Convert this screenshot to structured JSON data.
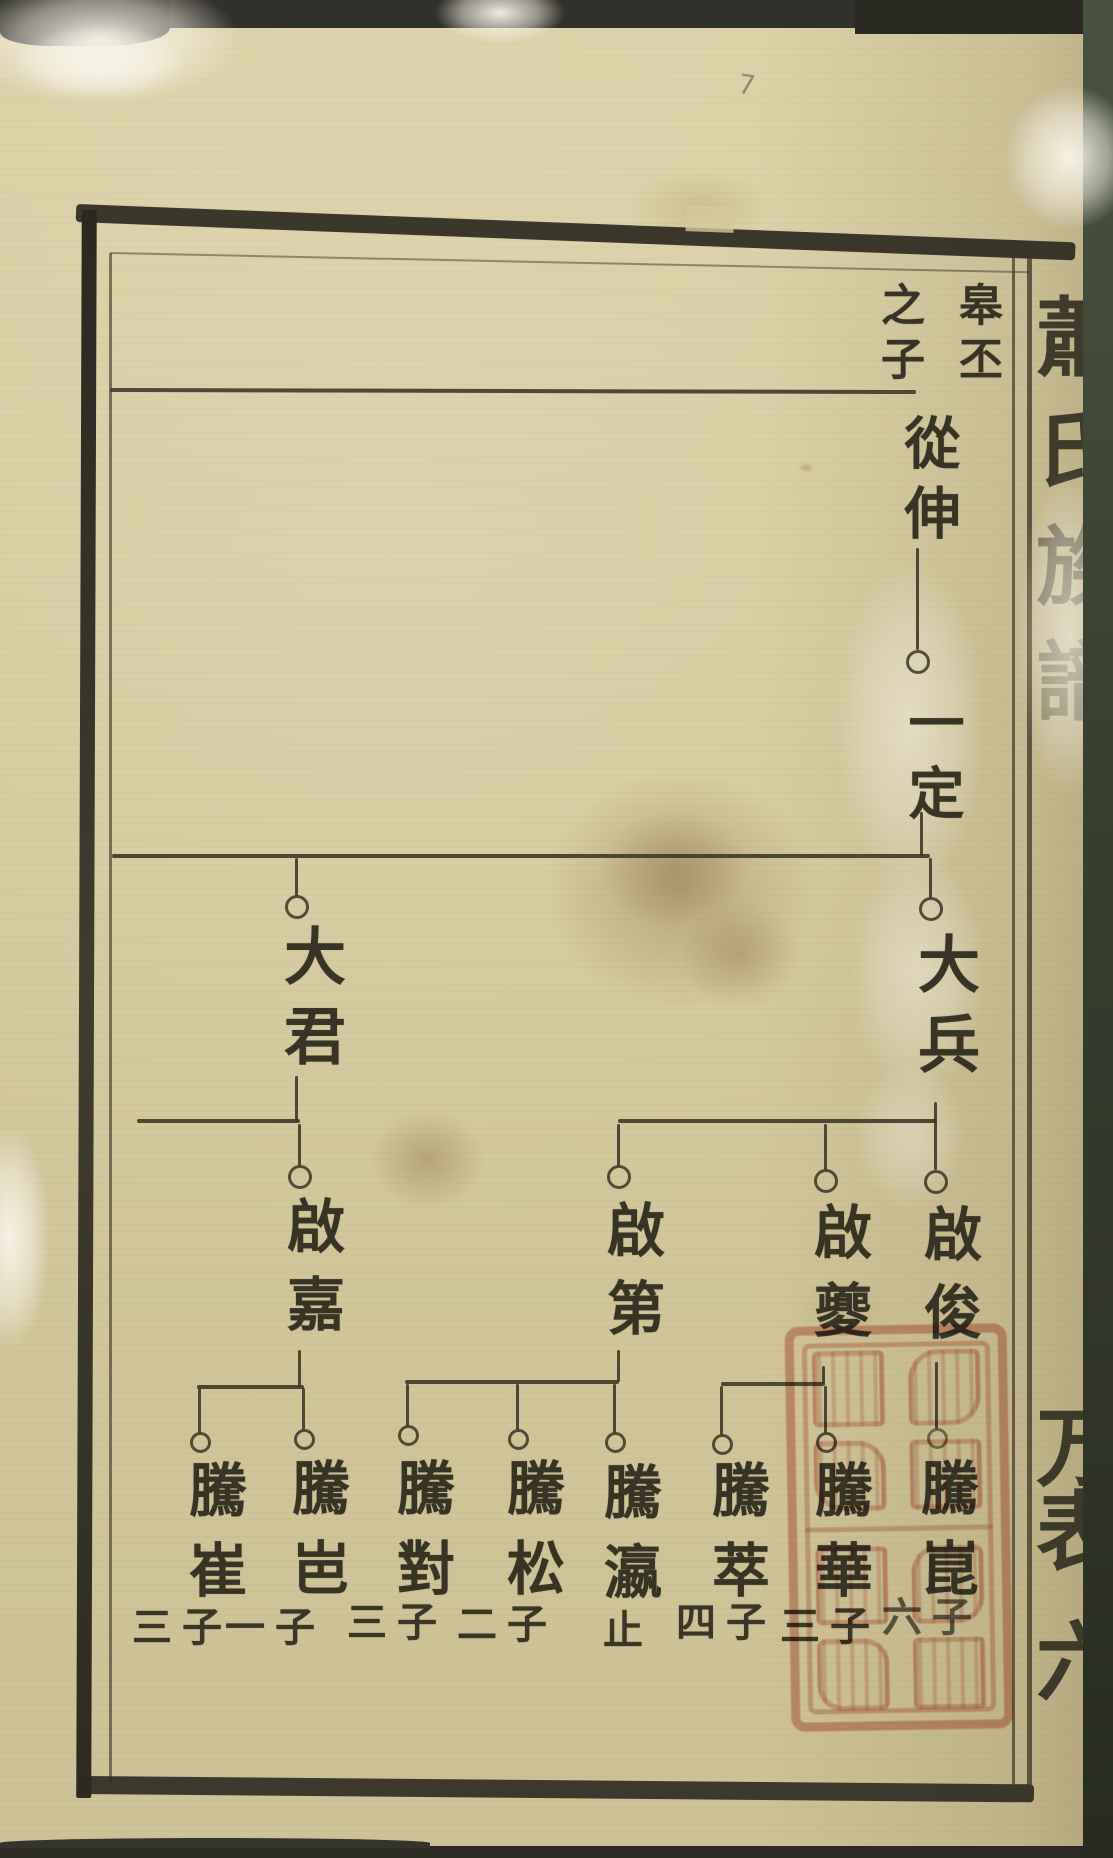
{
  "page": {
    "header_right_column": "皋丕",
    "header_left_column": "之子",
    "pencil_mark": "7",
    "spine_title_chars": [
      "蕭",
      "氏",
      "族",
      "譜"
    ],
    "spine_lower_chars": [
      "万",
      "表",
      "六"
    ]
  },
  "tree": {
    "gen1": {
      "name": "從伸"
    },
    "gen2": {
      "name": "一定"
    },
    "gen3": [
      {
        "name": "大君"
      },
      {
        "name": "大兵"
      }
    ],
    "gen4": [
      {
        "name": "啟嘉"
      },
      {
        "name": "啟第"
      },
      {
        "name": "啟夔"
      },
      {
        "name": "啟俊"
      }
    ],
    "gen5": [
      {
        "name": "騰崔",
        "note": "三子"
      },
      {
        "name": "騰岜",
        "note": "一子"
      },
      {
        "name": "騰對",
        "note": "三子"
      },
      {
        "name": "騰松",
        "note": "二子"
      },
      {
        "name": "騰瀛",
        "note": "止"
      },
      {
        "name": "騰萃",
        "note": "四子"
      },
      {
        "name": "騰華",
        "note": "三子"
      },
      {
        "name": "騰崑",
        "note": "六子"
      }
    ]
  }
}
